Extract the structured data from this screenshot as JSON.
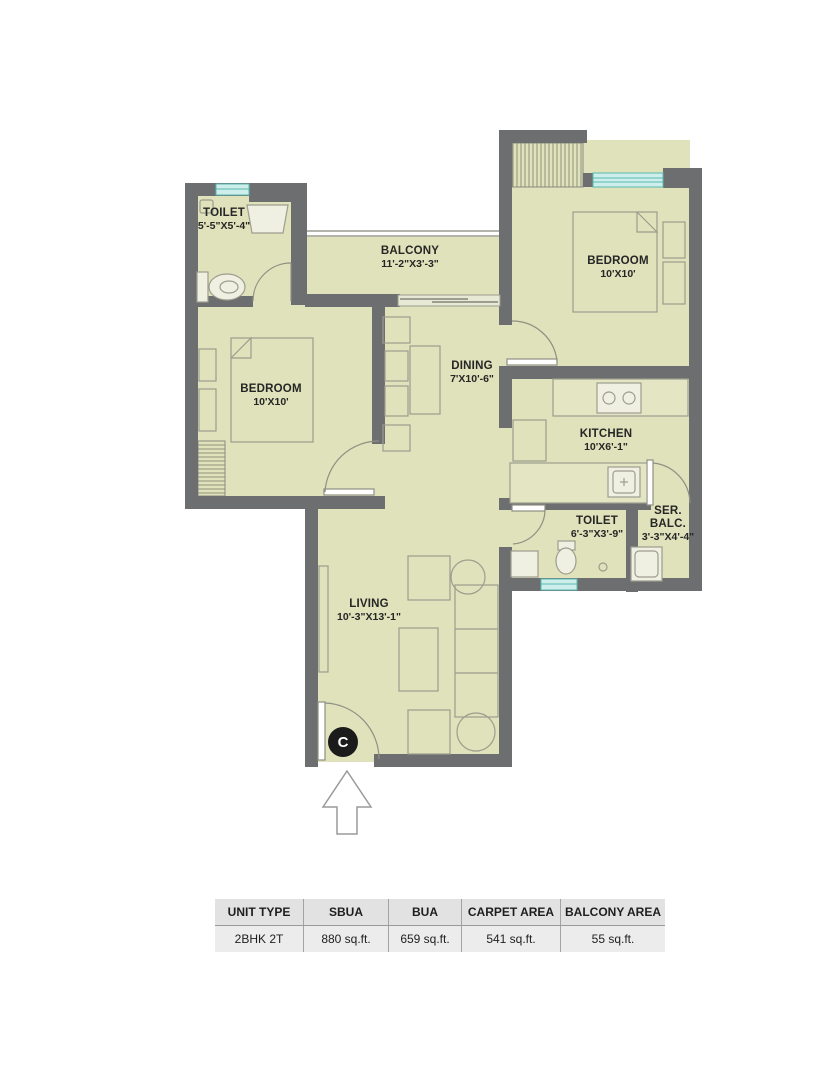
{
  "plan": {
    "badge": "C",
    "rooms": [
      {
        "id": "toilet-1",
        "name": "TOILET",
        "dims": "5'-5\"X5'-4\""
      },
      {
        "id": "balcony",
        "name": "BALCONY",
        "dims": "11'-2\"X3'-3\""
      },
      {
        "id": "bedroom-right",
        "name": "BEDROOM",
        "dims": "10'X10'"
      },
      {
        "id": "bedroom-left",
        "name": "BEDROOM",
        "dims": "10'X10'"
      },
      {
        "id": "dining",
        "name": "DINING",
        "dims": "7'X10'-6\""
      },
      {
        "id": "kitchen",
        "name": "KITCHEN",
        "dims": "10'X6'-1\""
      },
      {
        "id": "toilet-2",
        "name": "TOILET",
        "dims": "6'-3\"X3'-9\""
      },
      {
        "id": "service-balcony",
        "name": "SER.\nBALC.",
        "dims": "3'-3\"X4'-4\""
      },
      {
        "id": "living",
        "name": "LIVING",
        "dims": "10'-3\"X13'-1\""
      }
    ]
  },
  "area_table": {
    "headers": [
      "UNIT TYPE",
      "SBUA",
      "BUA",
      "CARPET AREA",
      "BALCONY AREA"
    ],
    "row": [
      "2BHK 2T",
      "880 sq.ft.",
      "659 sq.ft.",
      "541 sq.ft.",
      "55 sq.ft."
    ]
  },
  "colors": {
    "floor": "#dfe2ba",
    "wall": "#6d6e70",
    "window_teal": "#59b9b2",
    "furniture_line": "#9c9d8e"
  }
}
